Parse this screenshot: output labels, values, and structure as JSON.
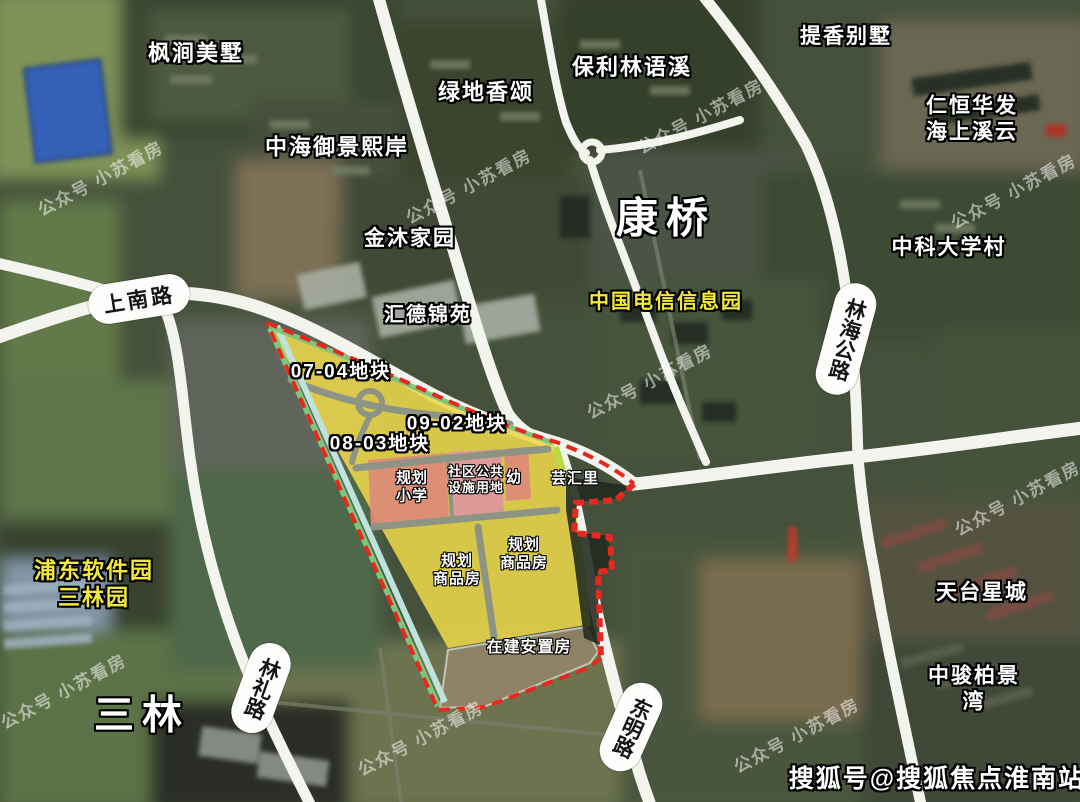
{
  "estates": {
    "fengjian": "枫涧美墅",
    "zhonghai": "中海御景熙岸",
    "lvdi": "绿地香颂",
    "baoli": "保利林语溪",
    "tixiang": "提香别墅",
    "renheng": "仁恒华发\n海上溪云",
    "zhongke": "中科大学村",
    "jinmu": "金沐家园",
    "huide": "汇德锦苑",
    "tiantai": "天台星城",
    "zhongjun": "中骏柏景湾"
  },
  "districts": {
    "kangqiao": "康桥",
    "sanlin": "三林"
  },
  "parks": {
    "dianxin": "中国电信信息园",
    "pudong": "浦东软件园\n三林园"
  },
  "roads": {
    "shangnan": "上南路",
    "linhai": "林海公路",
    "linli": "林礼路",
    "dongming": "东明路"
  },
  "plots": {
    "p0704": "07-04地块",
    "p0902": "09-02地块",
    "p0803": "08-03地块",
    "school": "规划\n小学",
    "community": "社区公共\n设施用地",
    "kindergarten": "幼",
    "yunhuili": "芸汇里",
    "commodity": "规划\n商品房",
    "resettlement": "在建安置房"
  },
  "watermark": "公众号 小苏看房",
  "credit": "搜狐号@搜狐焦点淮南站",
  "colors": {
    "plot_fill": "#ecd74a",
    "boundary_red": "#e8281e",
    "greenbelt": "#7fc57d",
    "cyan_strip": "#bfe2dc",
    "east_strip": "#b5dc40",
    "pink_block": "#dd8b78",
    "pink_block_light": "#e0979f",
    "road_white": "#f4f4ef",
    "highlight_text_yellow": "#f3e93c"
  }
}
